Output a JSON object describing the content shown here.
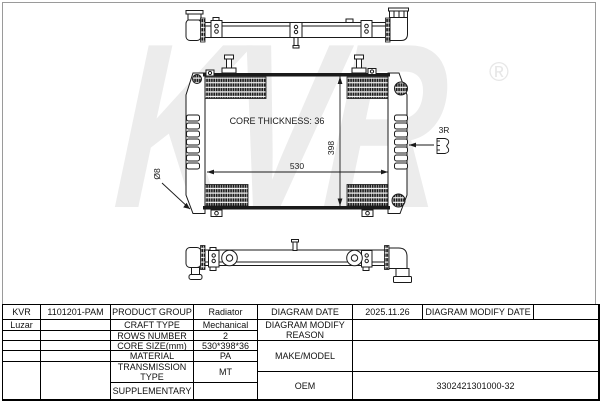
{
  "watermark": {
    "text": "KVR",
    "registered": "®"
  },
  "colors": {
    "line": "#1a1a1a",
    "watermark": "#ececec",
    "table_border": "#000000",
    "frame": "#9a9a9a"
  },
  "diagram": {
    "core_thickness_label": "CORE THICKNESS: 36",
    "dim_width": "530",
    "dim_height": "398",
    "dim_hole": "Ø8",
    "dim_radius": "3R"
  },
  "table": {
    "cells": [
      {
        "c": 1,
        "r": 1,
        "t": "KVR",
        "name": "brand-cell"
      },
      {
        "c": 2,
        "r": 1,
        "t": "1101201-PAM",
        "name": "part-number-cell"
      },
      {
        "c": 3,
        "r": 1,
        "t": "PRODUCT GROUP",
        "name": "product-group-label"
      },
      {
        "c": 4,
        "r": 1,
        "t": "Radiator",
        "name": "product-group-value"
      },
      {
        "c": 5,
        "r": 1,
        "t": "DIAGRAM DATE",
        "name": "diagram-date-label"
      },
      {
        "c": 6,
        "r": 1,
        "t": "2025.11.26",
        "name": "diagram-date-value"
      },
      {
        "c": 7,
        "r": 1,
        "t": "DIAGRAM MODIFY DATE",
        "name": "diagram-modify-date-label"
      },
      {
        "c": 8,
        "r": 1,
        "t": "",
        "name": "diagram-modify-date-value"
      },
      {
        "c": 1,
        "r": 2,
        "t": "Luzar",
        "name": "brand-alt-cell"
      },
      {
        "c": 2,
        "r": 2,
        "t": "",
        "name": "empty-cell"
      },
      {
        "c": 3,
        "r": 2,
        "t": "CRAFT TYPE",
        "name": "craft-type-label"
      },
      {
        "c": 4,
        "r": 2,
        "t": "Mechanical",
        "name": "craft-type-value"
      },
      {
        "c": 5,
        "r": 2,
        "rs": 2,
        "t": "DIAGRAM MODIFY REASON",
        "name": "diagram-modify-reason-label"
      },
      {
        "c": 6,
        "r": 2,
        "cs": 3,
        "rs": 2,
        "t": "",
        "name": "diagram-modify-reason-value"
      },
      {
        "c": 1,
        "r": 3,
        "t": "",
        "name": "empty-cell"
      },
      {
        "c": 2,
        "r": 3,
        "t": "",
        "name": "empty-cell"
      },
      {
        "c": 3,
        "r": 3,
        "t": "ROWS NUMBER",
        "name": "rows-number-label"
      },
      {
        "c": 4,
        "r": 3,
        "t": "2",
        "name": "rows-number-value"
      },
      {
        "c": 1,
        "r": 4,
        "t": "",
        "name": "empty-cell"
      },
      {
        "c": 2,
        "r": 4,
        "t": "",
        "name": "empty-cell"
      },
      {
        "c": 3,
        "r": 4,
        "t": "CORE SIZE(mm)",
        "name": "core-size-label"
      },
      {
        "c": 4,
        "r": 4,
        "t": "530*398*36",
        "name": "core-size-value"
      },
      {
        "c": 5,
        "r": 4,
        "rs": 3,
        "t": "MAKE/MODEL",
        "name": "make-model-label"
      },
      {
        "c": 6,
        "r": 4,
        "cs": 3,
        "rs": 3,
        "t": "",
        "name": "make-model-value"
      },
      {
        "c": 1,
        "r": 5,
        "t": "",
        "name": "empty-cell"
      },
      {
        "c": 2,
        "r": 5,
        "t": "",
        "name": "empty-cell"
      },
      {
        "c": 3,
        "r": 5,
        "t": "MATERIAL",
        "name": "material-label"
      },
      {
        "c": 4,
        "r": 5,
        "t": "PA",
        "name": "material-value"
      },
      {
        "c": 1,
        "r": 6,
        "rs": 3,
        "t": "",
        "name": "empty-cell"
      },
      {
        "c": 2,
        "r": 6,
        "rs": 3,
        "t": "",
        "name": "empty-cell"
      },
      {
        "c": 3,
        "r": 6,
        "rs": 2,
        "t": "TRANSMISSION TYPE",
        "name": "transmission-type-label"
      },
      {
        "c": 4,
        "r": 6,
        "rs": 2,
        "t": "MT",
        "name": "transmission-type-value"
      },
      {
        "c": 5,
        "r": 7,
        "rs": 2,
        "t": "OEM",
        "name": "oem-label"
      },
      {
        "c": 6,
        "r": 7,
        "cs": 3,
        "rs": 2,
        "t": "3302421301000-32",
        "name": "oem-value"
      },
      {
        "c": 3,
        "r": 8,
        "t": "SUPPLEMENTARY",
        "name": "supplementary-label"
      },
      {
        "c": 4,
        "r": 8,
        "t": "",
        "name": "supplementary-value"
      }
    ]
  }
}
